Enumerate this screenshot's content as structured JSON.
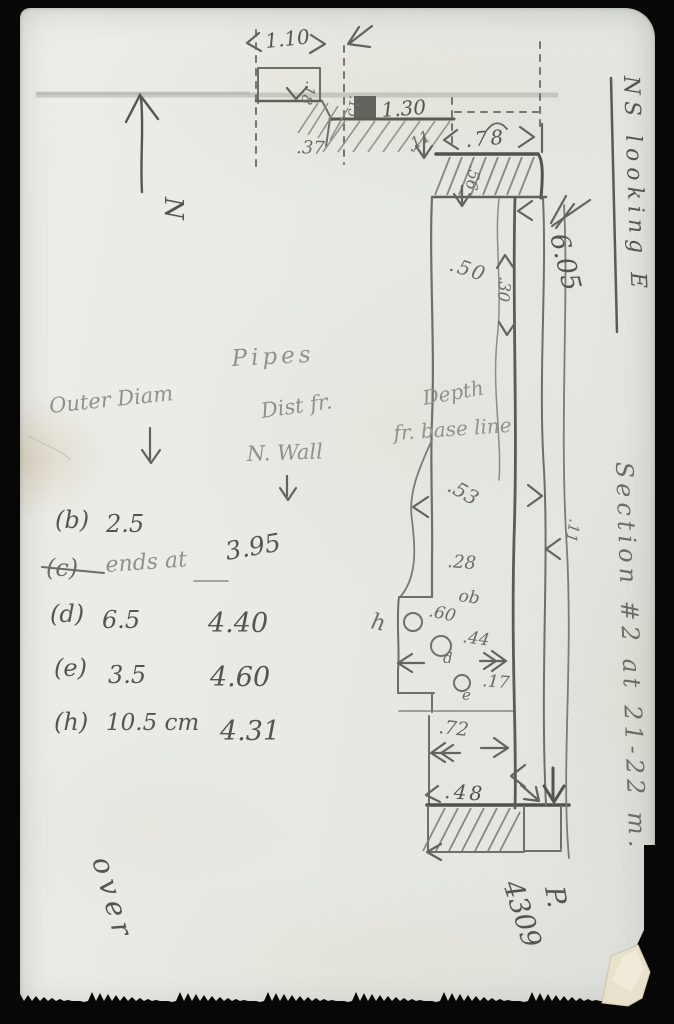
{
  "page": {
    "description": "Scanned handwritten excavation field note, pencil sketch on paper card",
    "paper_color": "#e9eae5",
    "background_color": "#070707",
    "pencil_color": "#6b6c66"
  },
  "compass": {
    "north_label": "N"
  },
  "margin_notes": {
    "title": "NS looking E",
    "east_offset": "6.05",
    "section_note": "Section #2 at 21-22 m.",
    "page_abbrev": "P.",
    "page_number": "4309",
    "over_note": "over"
  },
  "plan": {
    "depth_note_line1": "Depth",
    "depth_note_line2": "fr. base line",
    "dims": {
      "top_width": "1.10",
      "box_depth": ".18",
      "step_offset": ".15",
      "ledge_width": "1.30",
      "offset_left": ".37",
      "offset_small": ".11",
      "right_width": ".78",
      "band_depth": ".56",
      "inner_width": ".50",
      "wall_thickness": ".30",
      "right_gap": ".11",
      "depth_a": ".53",
      "depth_b": ".28",
      "mark_ob": "ob",
      "pipe_h_depth": ".60",
      "pipe_d_depth": ".44",
      "pipe_e_depth": ".17",
      "row_depth": ".72",
      "bottom_width": ".48"
    },
    "pipe_labels": {
      "h": "h",
      "d": "d",
      "e": "e"
    }
  },
  "pipes_table": {
    "title": "Pipes",
    "col_outer_diam": "Outer Diam",
    "col_dist_line1": "Dist fr.",
    "col_dist_line2": "N. Wall",
    "rows": [
      {
        "id": "(b)",
        "outer_diam": "2.5",
        "dist": ""
      },
      {
        "id": "(c)",
        "outer_diam": "ends at",
        "dist": "3.95",
        "struck_out": true
      },
      {
        "id": "(d)",
        "outer_diam": "6.5",
        "dist": "4.40"
      },
      {
        "id": "(e)",
        "outer_diam": "3.5",
        "dist": "4.60"
      },
      {
        "id": "(h)",
        "outer_diam": "10.5 cm",
        "dist": "4.31"
      }
    ]
  }
}
